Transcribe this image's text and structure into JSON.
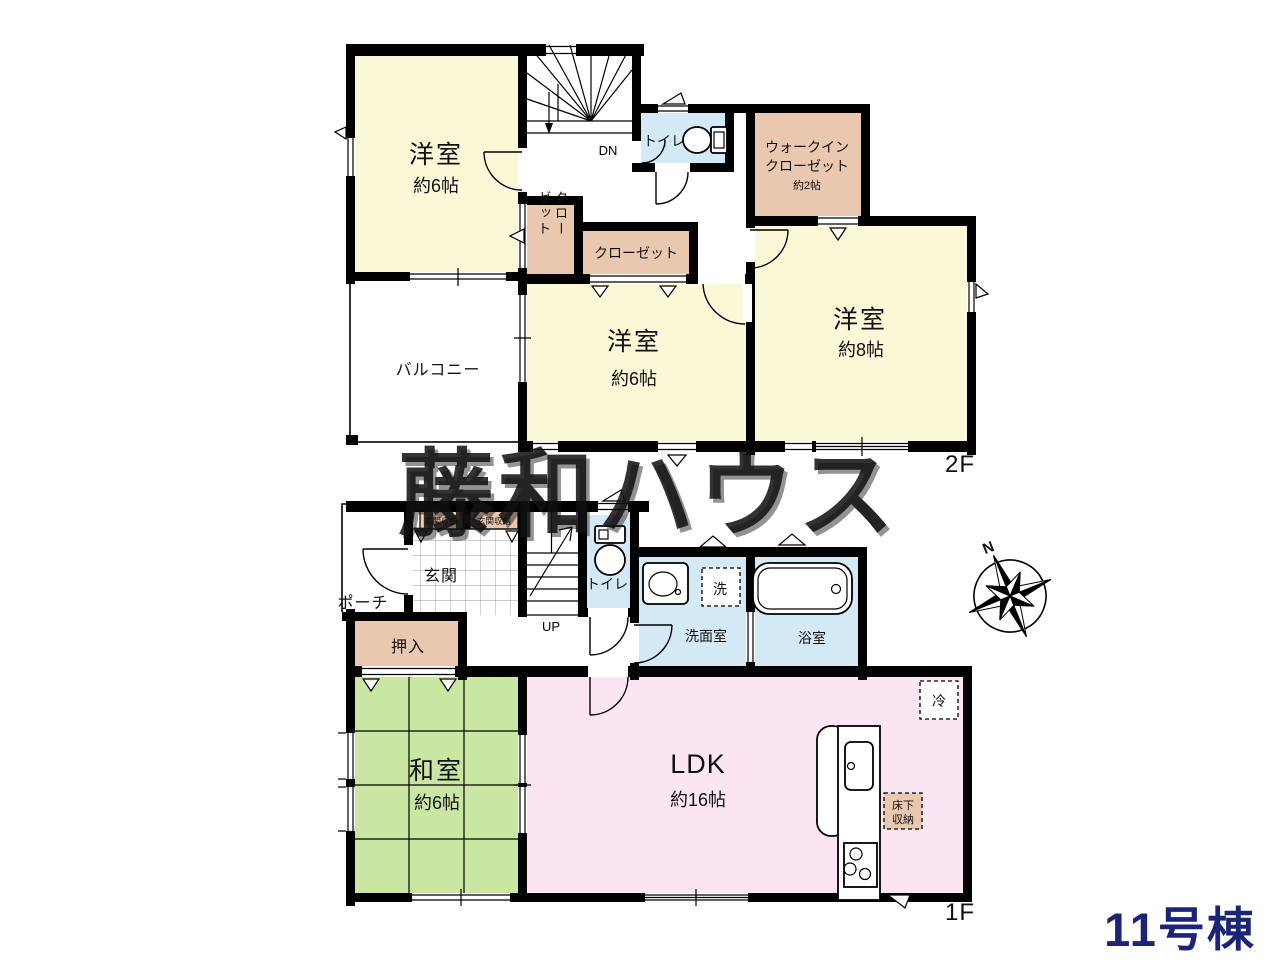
{
  "watermark": "藤和ハウス",
  "building_label": "11号棟",
  "compass": {
    "north": "N"
  },
  "colors": {
    "room_yellow": "#FAF8D6",
    "closet_tan": "#EAC7AF",
    "wet_blue": "#D4E9F6",
    "tatami_green": "#C9E7A2",
    "ldk_pink": "#FBE5F2",
    "wall_black": "#000000",
    "building_label_navy": "#1A2478"
  },
  "floor2": {
    "label": "2F",
    "bedroom_nw": {
      "name": "洋室",
      "size": "約6帖"
    },
    "bedroom_mid": {
      "name": "洋室",
      "size": "約6帖"
    },
    "bedroom_e": {
      "name": "洋室",
      "size": "約8帖"
    },
    "walkin_closet": {
      "line1": "ウォークイン",
      "line2": "クローゼット",
      "size": "約2帖"
    },
    "closet_small": {
      "col_right": "クロー",
      "col_left": "ゼット"
    },
    "closet_wide": "クローゼット",
    "toilet": "トイレ",
    "balcony": "バルコニー",
    "stairs": "DN"
  },
  "floor1": {
    "label": "1F",
    "porch": "ポーチ",
    "entry": "玄関",
    "entry_storage_left": "玄関収納",
    "entry_storage_right": "玄関収納",
    "closet_oshiire": "押入",
    "japanese_room": {
      "name": "和室",
      "size": "約6帖"
    },
    "stairs": "UP",
    "toilet": "トイレ",
    "washroom": "洗面室",
    "laundry": "洗",
    "bathroom": "浴室",
    "ldk": {
      "name": "LDK",
      "size": "約16帖"
    },
    "fridge": "冷",
    "underfloor_storage": {
      "line1": "床下",
      "line2": "収納"
    }
  }
}
